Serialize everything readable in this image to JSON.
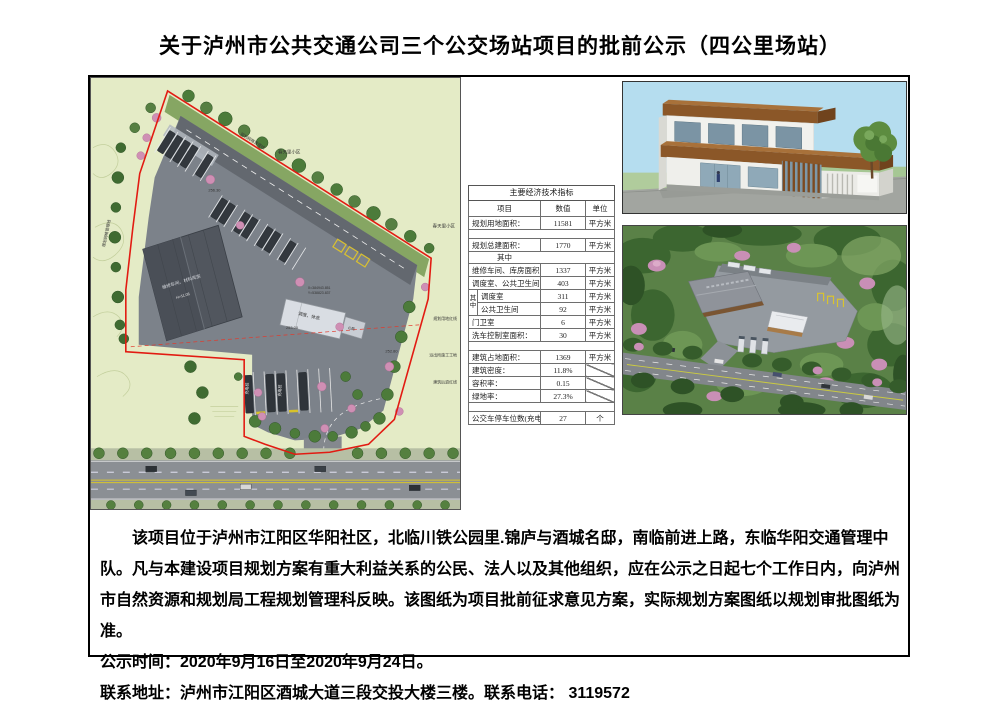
{
  "title": "关于泸州市公共交通公司三个公交场站项目的批前公示（四公里场站）",
  "table": {
    "title": "主要经济技术指标",
    "columns": [
      "项目",
      "数值",
      "单位"
    ],
    "rows": [
      {
        "item": "规划用地面积：",
        "value": "11581",
        "unit": "平方米"
      },
      {
        "blank": true
      },
      {
        "item": "规划总建面积：",
        "value": "1770",
        "unit": "平方米"
      },
      {
        "header": "其中"
      },
      {
        "item": "维修车间、库房面积：",
        "value": "1337",
        "unit": "平方米"
      },
      {
        "item": "调度室、公共卫生间",
        "value": "403",
        "unit": "平方米"
      },
      {
        "group": "其中",
        "groupspan": 2,
        "item": "调度室",
        "value": "311",
        "unit": "平方米"
      },
      {
        "ingroup": true,
        "item": "公共卫生间",
        "value": "92",
        "unit": "平方米"
      },
      {
        "item": "门卫室",
        "value": "6",
        "unit": "平方米"
      },
      {
        "item": "洗车控制室面积：",
        "value": "30",
        "unit": "平方米"
      },
      {
        "blank": true
      },
      {
        "item": "建筑占地面积：",
        "value": "1369",
        "unit": "平方米"
      },
      {
        "item": "建筑密度：",
        "value": "11.8%",
        "unit": "",
        "diag": true
      },
      {
        "item": "容积率：",
        "value": "0.15",
        "unit": "",
        "diag": true
      },
      {
        "item": "绿地率：",
        "value": "27.3%",
        "unit": "",
        "diag": true
      },
      {
        "blank": true
      },
      {
        "item": "公交车停车位数(充电桩)：",
        "value": "27",
        "unit": "个"
      }
    ]
  },
  "site_plan": {
    "labels": {
      "grid_line_top": "规划网格管理线",
      "grid_line_left": "规划网格管理线",
      "neighborhood_top": "春天里小区",
      "neighborhood_right": "春天里小区",
      "red_line": "规划用地红线",
      "construction_site": "派出所施工工地",
      "setback_line": "建筑后退红线",
      "workshop": "维修车间、材料库房",
      "dispatch": "调度、休息",
      "toilet": "公厕",
      "charging": "充电桩",
      "elev_a": "256.30",
      "elev_b": "253.00",
      "elev_c": "252.80",
      "height_mark": "H=11.06",
      "coord_x": "X=384943.851",
      "coord_y": "Y=538823.837"
    }
  },
  "notice": {
    "paragraph": "该项目位于泸州市江阳区华阳社区，北临川铁公园里.锦庐与酒城名邸，南临前进上路，东临华阳交通管理中队。凡与本建设项目规划方案有重大利益关系的公民、法人以及其他组织，应在公示之日起七个工作日内，向泸州市自然资源和规划局工程规划管理科反映。该图纸为项目批前征求意见方案，实际规划方案图纸以规划审批图纸为准。",
    "publicity_time": "公示时间：2020年9月16日至2020年9月24日。",
    "contact": "联系地址：泸州市江阳区酒城大道三段交投大楼三楼。联系电话： 3119572"
  }
}
